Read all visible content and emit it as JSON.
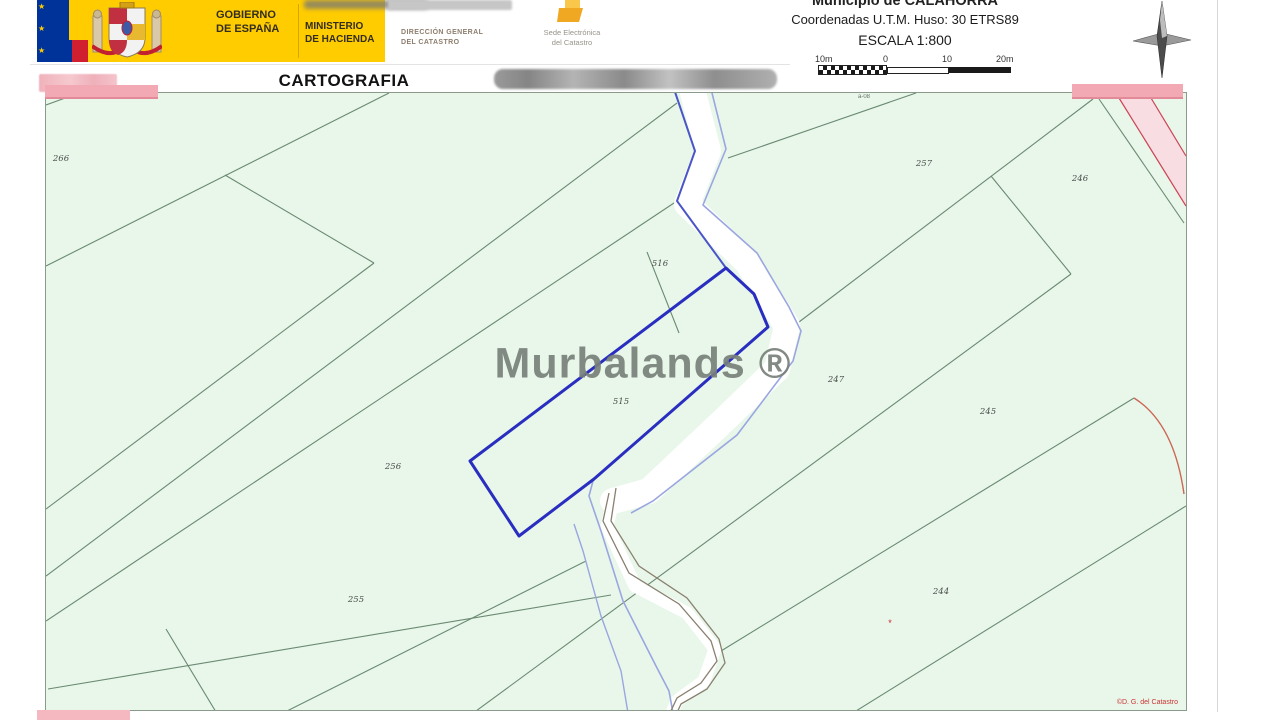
{
  "header": {
    "gobierno": {
      "l1": "GOBIERNO",
      "l2": "DE ESPAÑA"
    },
    "ministerio": {
      "l1": "MINISTERIO",
      "l2": "DE HACIENDA"
    },
    "direccion": {
      "l1": "DIRECCIÓN GENERAL",
      "l2": "DEL CATASTRO"
    },
    "sede": {
      "l1": "Sede Electrónica",
      "l2": "del Catastro"
    },
    "municipio": "Municipio de CALAHORRA",
    "coordenadas": "Coordenadas U.T.M. Huso: 30 ETRS89",
    "escala": "ESCALA 1:800",
    "scalebar": {
      "labels": [
        "10m",
        "0",
        "10",
        "20m"
      ]
    },
    "title": "CARTOGRAFIA CATASTRAL"
  },
  "map": {
    "watermark": "Murbalands ®",
    "copyright": "©D. G. del Catastro",
    "edge_label": "a-08",
    "marker": "*",
    "highlighted_parcel_id": "515",
    "parcels": [
      {
        "id": "266",
        "x": 15,
        "y": 66
      },
      {
        "id": "516",
        "x": 614,
        "y": 171
      },
      {
        "id": "257",
        "x": 878,
        "y": 71
      },
      {
        "id": "246",
        "x": 1034,
        "y": 86
      },
      {
        "id": "515",
        "x": 575,
        "y": 309
      },
      {
        "id": "247",
        "x": 790,
        "y": 287
      },
      {
        "id": "256",
        "x": 347,
        "y": 374
      },
      {
        "id": "245",
        "x": 942,
        "y": 319
      },
      {
        "id": "255",
        "x": 310,
        "y": 507
      },
      {
        "id": "244",
        "x": 895,
        "y": 499
      }
    ]
  },
  "colors": {
    "parcel_outline": "#2a2ec0",
    "map_background": "#e8f7ea",
    "field_line": "#6b8a72",
    "stream_blue": "#4a55c8",
    "stream_light_blue": "#9aa6e0",
    "stream_bank_gray": "#8a8070",
    "pink_redaction": "#f2a9b4",
    "header_yellow": "#ffcc00",
    "flag_blue": "#003399",
    "flag_red": "#d02030",
    "detail_red": "#cc3344",
    "watermark_gray": "#79817a"
  }
}
